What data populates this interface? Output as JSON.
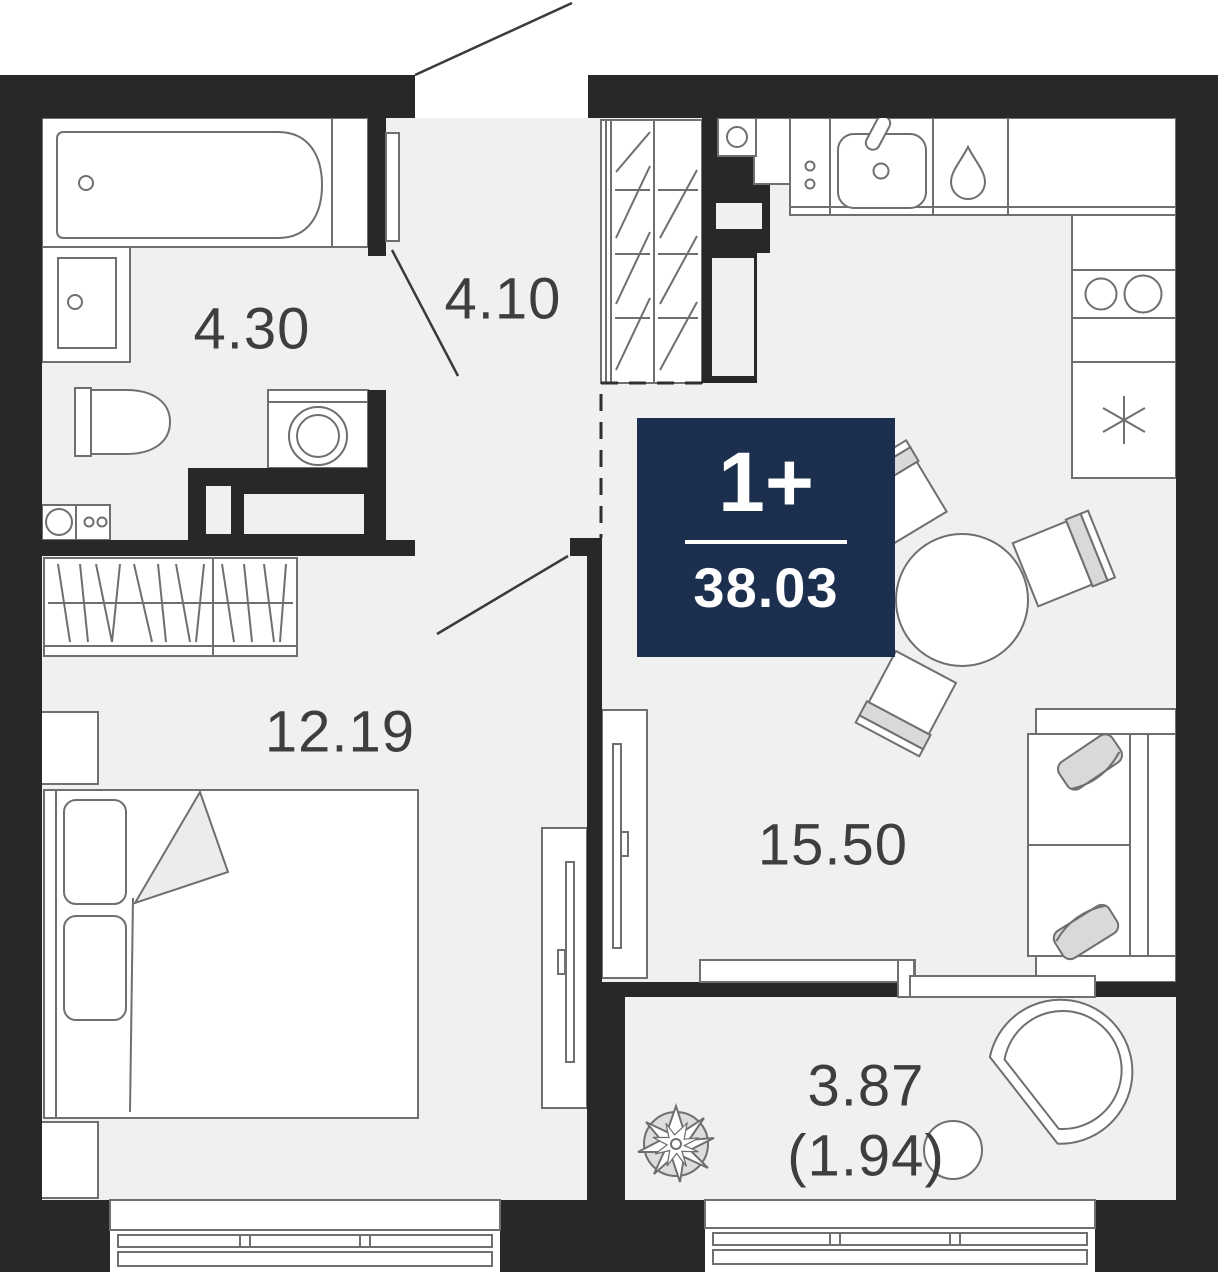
{
  "floorplan": {
    "badge": {
      "rooms_label": "1+",
      "total_area": "38.03",
      "bg_color": "#1c2f4f",
      "text_color": "#ffffff"
    },
    "rooms": {
      "bathroom": {
        "label": "4.30"
      },
      "hallway": {
        "label": "4.10"
      },
      "bedroom": {
        "label": "12.19"
      },
      "kitchen_living": {
        "label": "15.50"
      },
      "balcony": {
        "label": "3.87",
        "label_reduced": "(1.94)"
      }
    },
    "colors": {
      "wall": "#282828",
      "floor": "#eff1f0",
      "furniture_outline": "#6f6f6f",
      "label_text": "#3e3e3e",
      "cushion": "#d9d9d9",
      "badge_bg": "#1c2f4f"
    }
  }
}
